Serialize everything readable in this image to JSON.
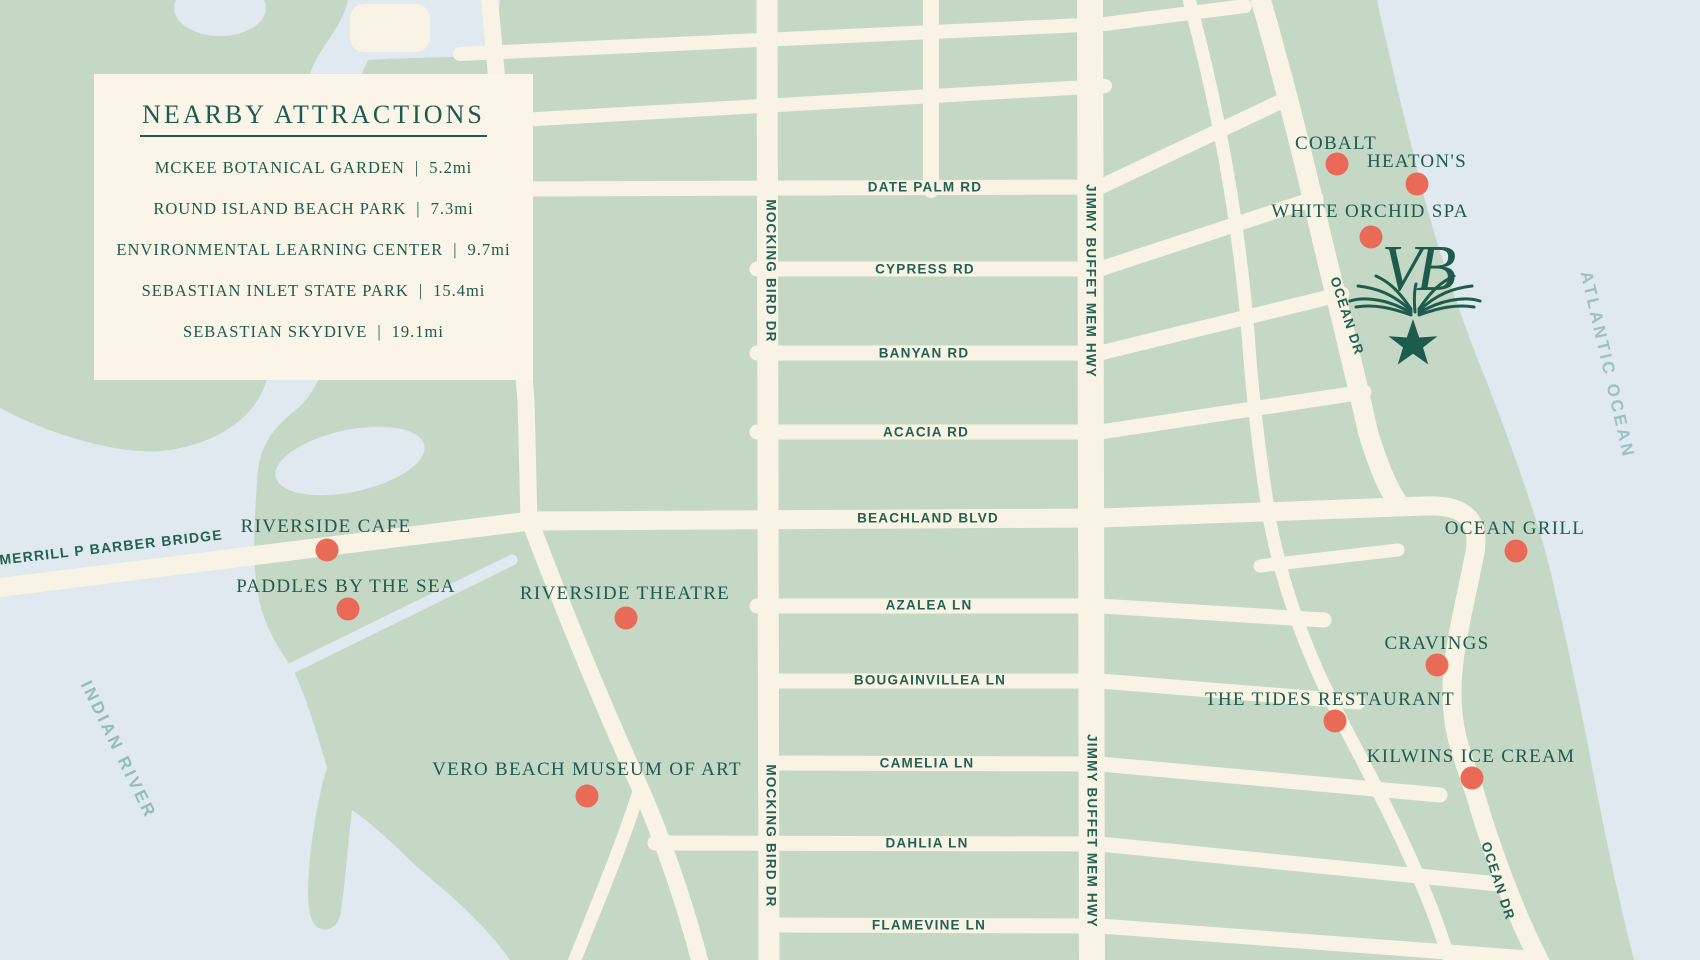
{
  "legend": {
    "title": "NEARBY ATTRACTIONS",
    "separator": "|",
    "items": [
      {
        "label": "MCKEE BOTANICAL GARDEN",
        "distance": "5.2mi"
      },
      {
        "label": "ROUND ISLAND BEACH PARK",
        "distance": "7.3mi"
      },
      {
        "label": "ENVIRONMENTAL LEARNING CENTER",
        "distance": "9.7mi"
      },
      {
        "label": "SEBASTIAN INLET STATE PARK",
        "distance": "15.4mi"
      },
      {
        "label": "SEBASTIAN SKYDIVE",
        "distance": "19.1mi"
      }
    ]
  },
  "streets": {
    "date_palm": "DATE PALM RD",
    "cypress": "CYPRESS RD",
    "banyan": "BANYAN RD",
    "acacia": "ACACIA RD",
    "beachland": "BEACHLAND BLVD",
    "azalea": "AZALEA LN",
    "bougainvillea": "BOUGAINVILLEA LN",
    "camelia": "CAMELIA LN",
    "dahlia": "DAHLIA LN",
    "flamevine": "FLAMEVINE LN",
    "mocking_bird": "MOCKING BIRD DR",
    "jimmy_buffet": "JIMMY BUFFET MEM HWY",
    "ocean_dr": "OCEAN DR",
    "bridge": "MERRILL P BARBER BRIDGE"
  },
  "pois": [
    {
      "label": "COBALT"
    },
    {
      "label": "HEATON'S"
    },
    {
      "label": "WHITE ORCHID SPA"
    },
    {
      "label": "RIVERSIDE CAFE"
    },
    {
      "label": "PADDLES BY THE SEA"
    },
    {
      "label": "RIVERSIDE THEATRE"
    },
    {
      "label": "VERO BEACH MUSEUM OF ART"
    },
    {
      "label": "OCEAN GRILL"
    },
    {
      "label": "CRAVINGS"
    },
    {
      "label": "THE TIDES RESTAURANT"
    },
    {
      "label": "KILWINS ICE CREAM"
    }
  ],
  "water_labels": {
    "indian_river": "INDIAN RIVER",
    "atlantic_ocean": "ATLANTIC OCEAN"
  },
  "logo": {
    "monogram": "VB"
  },
  "colors": {
    "land": "#c5d8c5",
    "water": "#e0e8f0",
    "road": "#f8f3e4",
    "legend_bg": "#faf5e8",
    "dark_green_text": "#1d5c4d",
    "street_text": "#226253",
    "poi_dot": "#ea6a58",
    "water_text": "#9cc2c4"
  }
}
